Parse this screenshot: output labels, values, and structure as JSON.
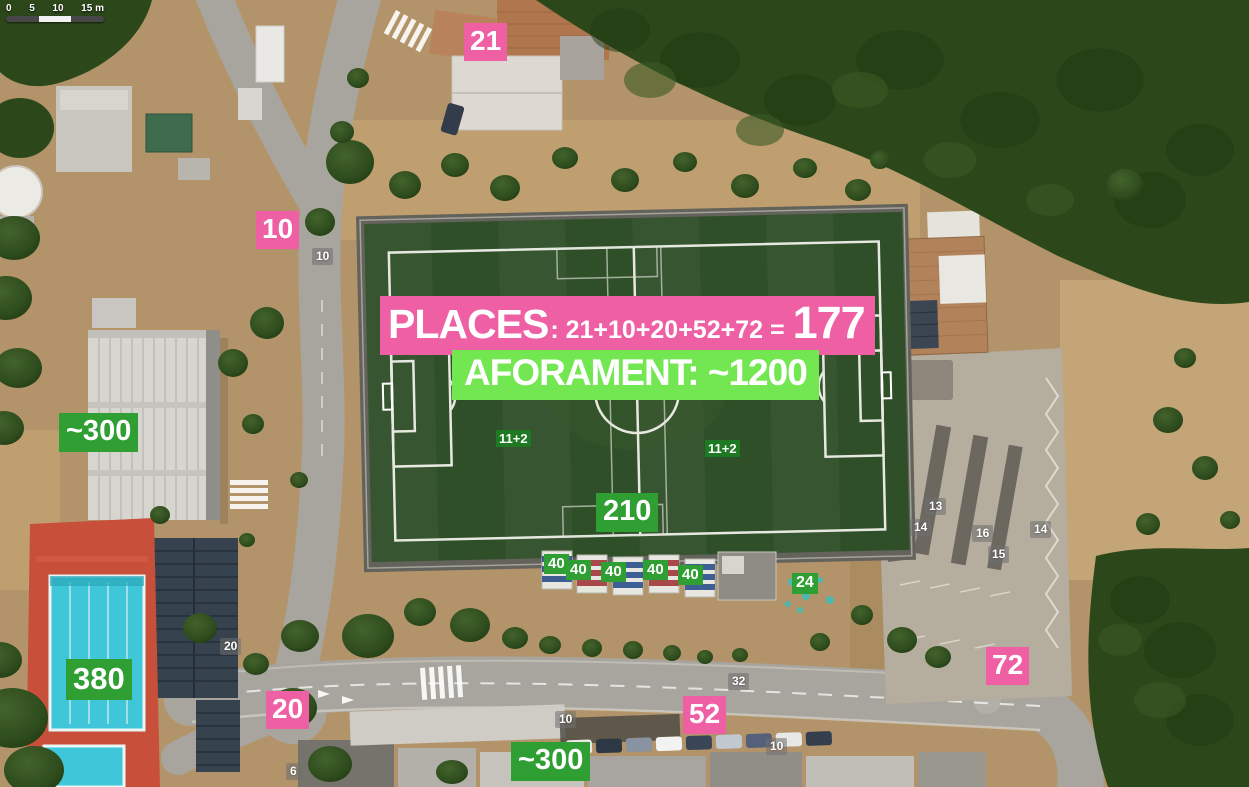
{
  "map": {
    "scale": {
      "t0": "0",
      "t5": "5",
      "t10": "10",
      "t15": "15 m"
    }
  },
  "banners": {
    "places": {
      "title": "PLACES",
      "formula": ": 21+10+20+52+72 =",
      "total": "177"
    },
    "aforament": {
      "text": "AFORAMENT: ~1200"
    }
  },
  "pink": {
    "p21": "21",
    "p10": "10",
    "p20": "20",
    "p52": "52",
    "p72": "72"
  },
  "green": {
    "left300": "~300",
    "pitch210": "210",
    "pool380": "380",
    "bottom300": "~300",
    "n24": "24",
    "s1": "40",
    "s2": "40",
    "s3": "40",
    "s4": "40",
    "s5": "40",
    "teamL": "11+2",
    "teamR": "11+2"
  },
  "streets": {
    "a10": "10",
    "b20": "20",
    "c32": "32",
    "d10": "10",
    "e10": "10",
    "f6": "6",
    "g13": "13",
    "h14": "14",
    "i16": "16",
    "j15": "15",
    "k14": "14"
  },
  "colors": {
    "pink": "#ee5fa3",
    "green": "#2f9e33",
    "light_green": "#72e751",
    "dark_green_label": "#1e7a22",
    "turf": "#2f4f28"
  }
}
